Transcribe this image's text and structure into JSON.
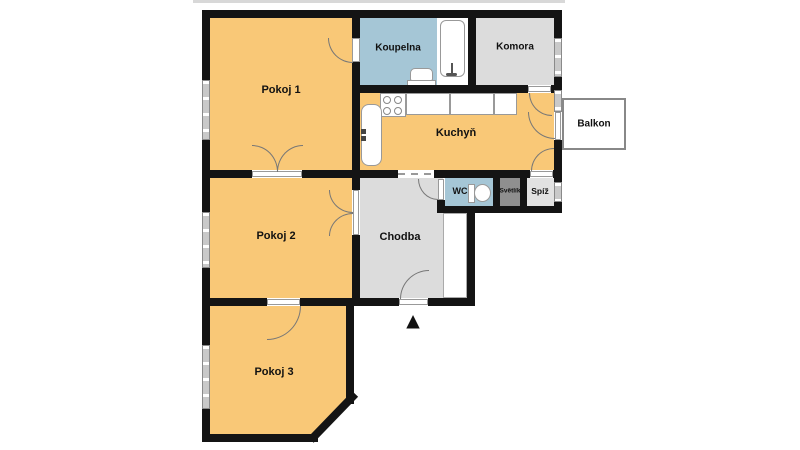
{
  "rooms": {
    "pokoj1": {
      "label": "Pokoj 1"
    },
    "pokoj2": {
      "label": "Pokoj 2"
    },
    "pokoj3": {
      "label": "Pokoj 3"
    },
    "kuchyn": {
      "label": "Kuchyň"
    },
    "koupelna": {
      "label": "Koupelna"
    },
    "komora": {
      "label": "Komora"
    },
    "chodba": {
      "label": "Chodba"
    },
    "wc": {
      "label": "WC"
    },
    "svetlik": {
      "label": "Světlík"
    },
    "spiz": {
      "label": "Spíž"
    },
    "balkon": {
      "label": "Balkon"
    }
  },
  "icons": {
    "entrance_arrow": "▲"
  },
  "colors": {
    "room_orange": "#F9C877",
    "room_blue": "#A5C6D6",
    "room_gray": "#DCDCDC",
    "room_darkgray": "#8F8F8F",
    "wall": "#141414",
    "window_gray": "#C9C9C9"
  }
}
